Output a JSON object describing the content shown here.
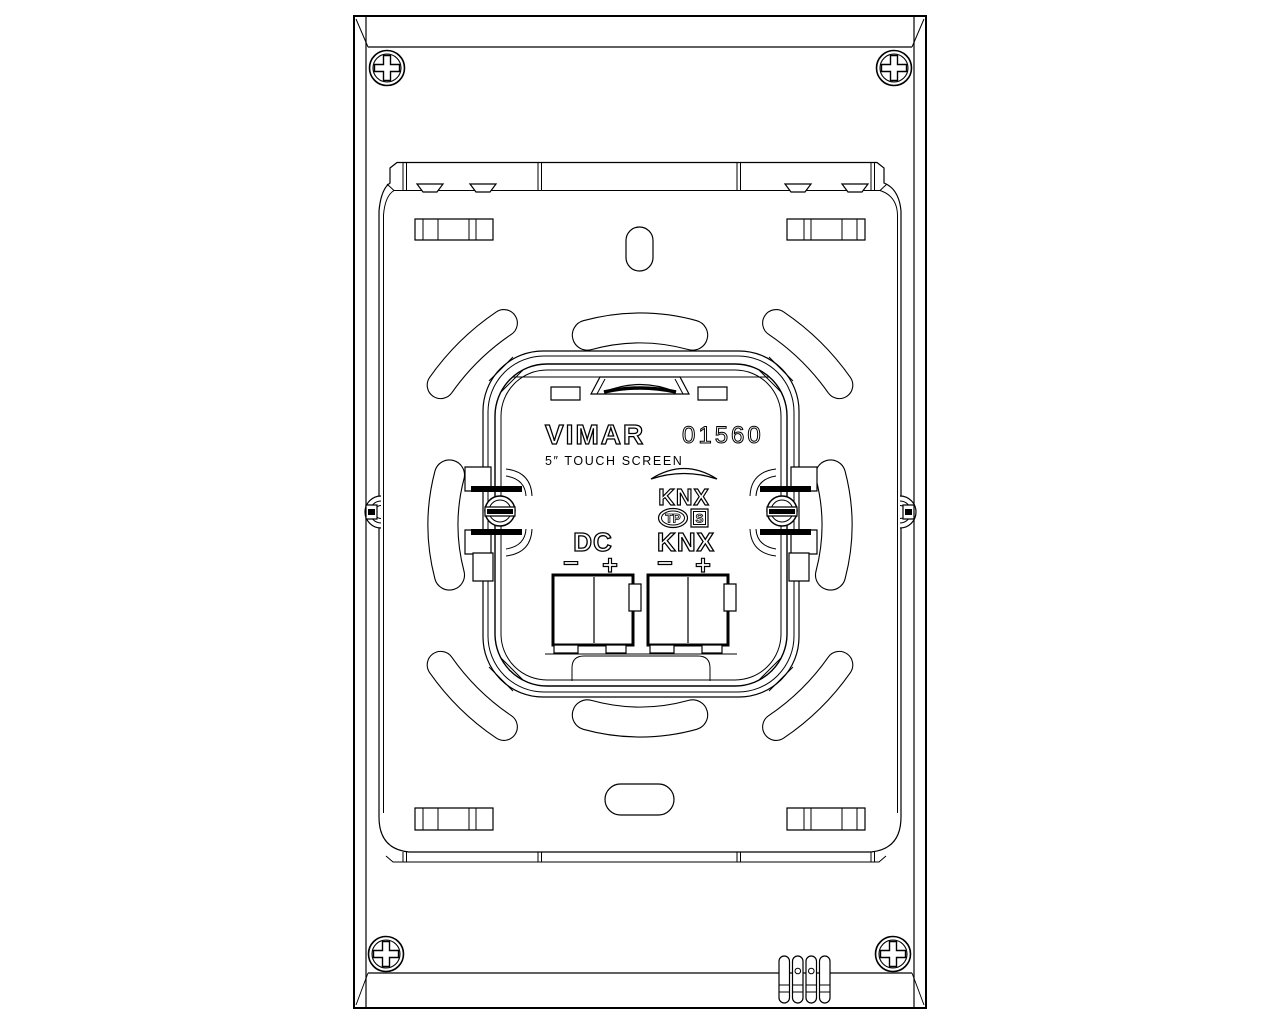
{
  "title": "Rear view technical drawing",
  "module": {
    "brand": "VIMAR",
    "article_number": "01560",
    "product_name": "5″ TOUCH SCREEN",
    "knx_certification": {
      "logo_text": "KNX",
      "medium_badge": "TP",
      "s_badge": "S"
    },
    "terminals": {
      "dc_label": "DC",
      "knx_label": "KNX",
      "minus_sign": "−",
      "plus_sign": "+"
    }
  },
  "colors": {
    "line": "#000000",
    "background": "#ffffff"
  }
}
